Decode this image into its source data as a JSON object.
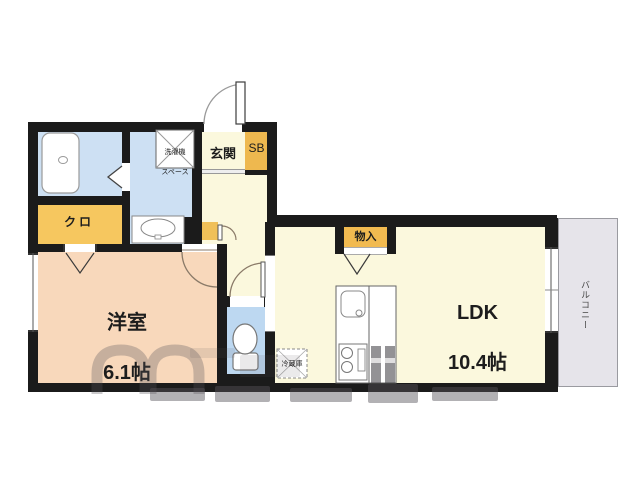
{
  "floorplan": {
    "rooms": {
      "entrance": {
        "label": "玄関"
      },
      "shoe_box": {
        "label": "SB"
      },
      "washer_space": {
        "line1": "洗濯機",
        "line2": "スペース"
      },
      "closet": {
        "label": "クロ"
      },
      "western_room": {
        "name": "洋室",
        "size": "6.1帖"
      },
      "ldk": {
        "name": "LDK",
        "size": "10.4帖"
      },
      "storage": {
        "label": "物入"
      },
      "refrigerator": {
        "label": "冷蔵庫"
      },
      "balcony": {
        "label": "バルコニー"
      }
    },
    "colors": {
      "wall": "#1b1b1b",
      "wet_area_blue": "#cde0f3",
      "toilet_blue": "#bdd8f1",
      "hall_ldk_cream": "#fbf8dd",
      "western_room_peach": "#f8d8bb",
      "storage_orange": "#f2bd55",
      "balcony_gray": "#e6e4ea"
    }
  }
}
